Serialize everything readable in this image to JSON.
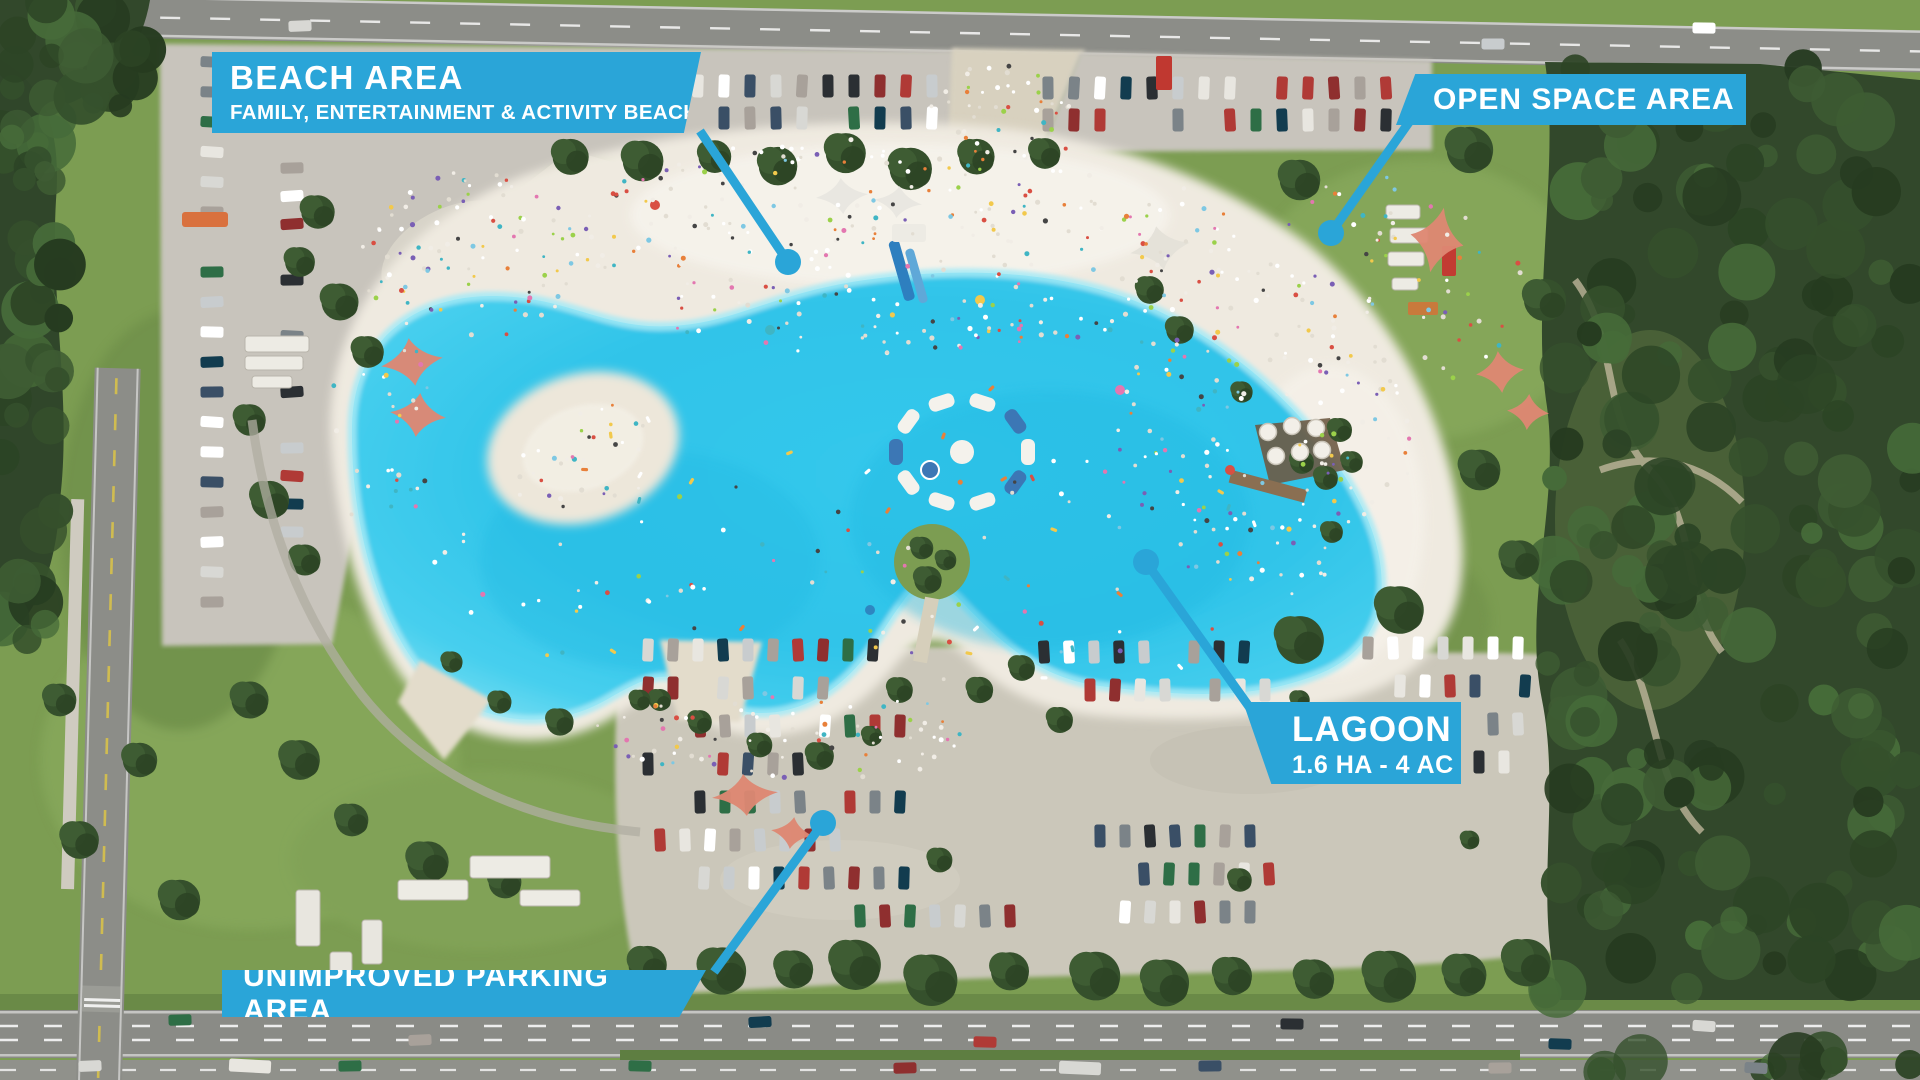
{
  "labels": {
    "beach_area": {
      "title": "BEACH AREA",
      "subtitle": "FAMILY, ENTERTAINMENT & ACTIVITY BEACH"
    },
    "open_space": {
      "title": "OPEN SPACE AREA"
    },
    "lagoon": {
      "title": "LAGOON",
      "subtitle": "1.6 ha -  4 ac"
    },
    "unimproved_parking": {
      "title": "UNIMPROVED PARKING AREA"
    }
  },
  "colors": {
    "callout_blue": "#2AA5D8",
    "lagoon_water": "#30C5E9",
    "lagoon_shallow": "#A5EAF6",
    "beach_sand": "#EFEAE0",
    "grass": "#7C9D52",
    "forest": "#32482B",
    "coral_sail": "#DE8773",
    "road_asphalt": "#8C8D88",
    "parking_surface": "#C8C4BC"
  }
}
